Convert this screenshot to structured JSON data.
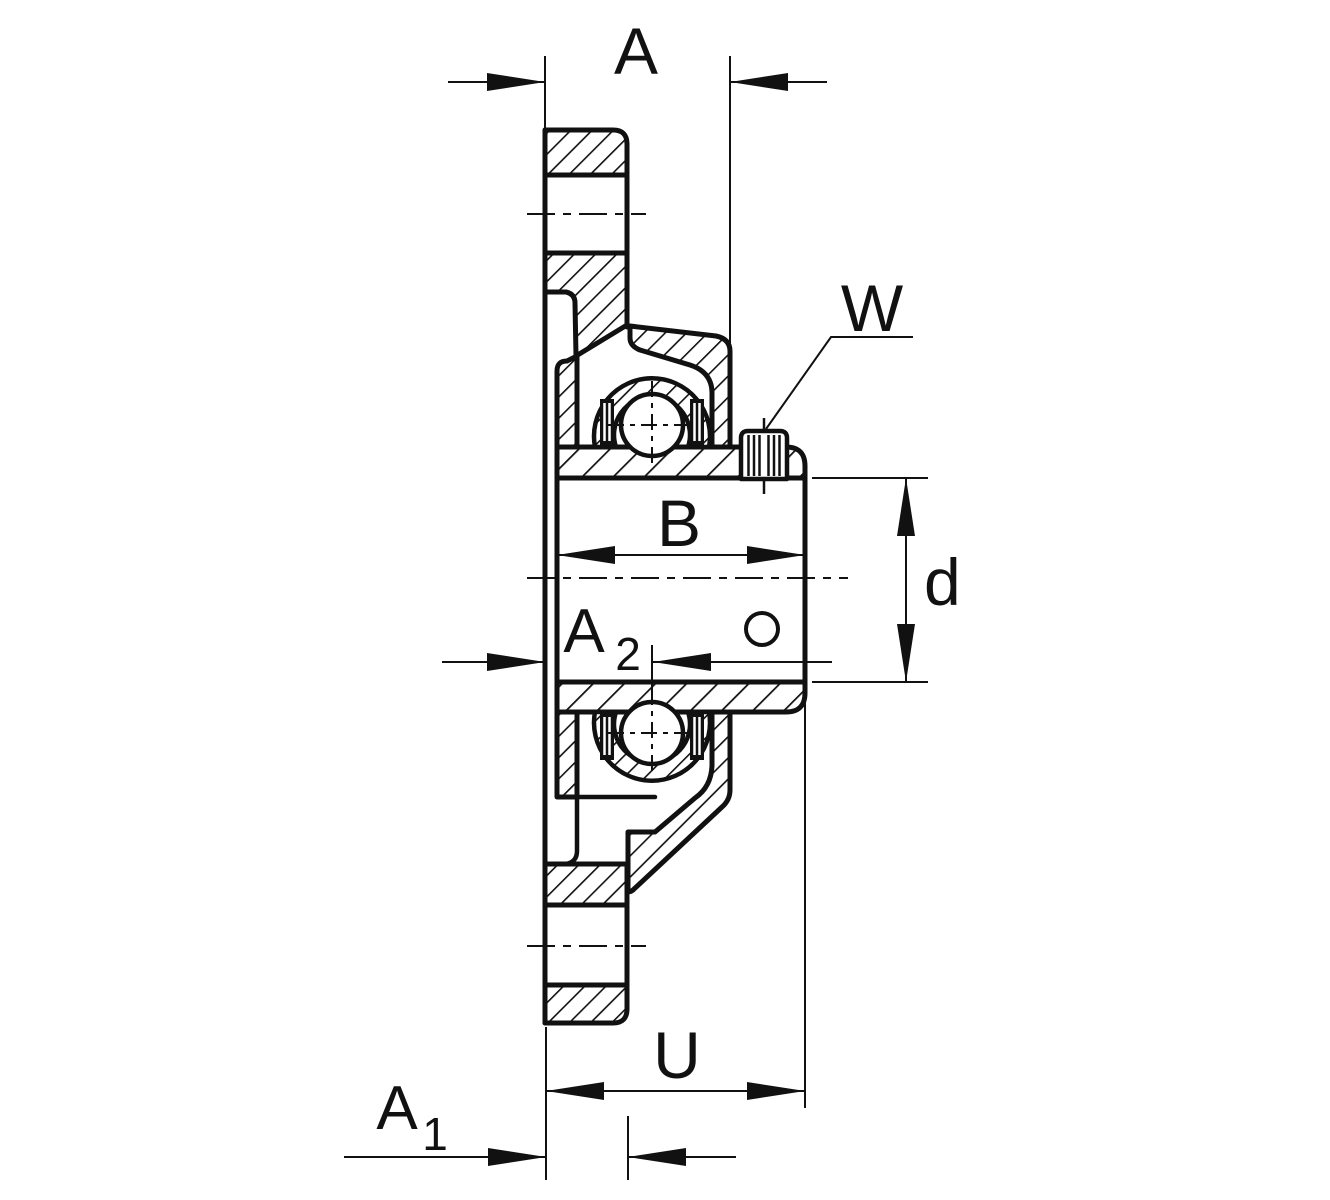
{
  "drawing": {
    "description": "Sectional technical drawing of a flanged bearing unit with dimension annotations",
    "background_color": "#ffffff",
    "line_color": "#111111"
  },
  "labels": {
    "A": "A",
    "W": "W",
    "B": "B",
    "d": "d",
    "A2_main": "A",
    "A2_sub": "2",
    "U": "U",
    "A1_main": "A",
    "A1_sub": "1"
  }
}
